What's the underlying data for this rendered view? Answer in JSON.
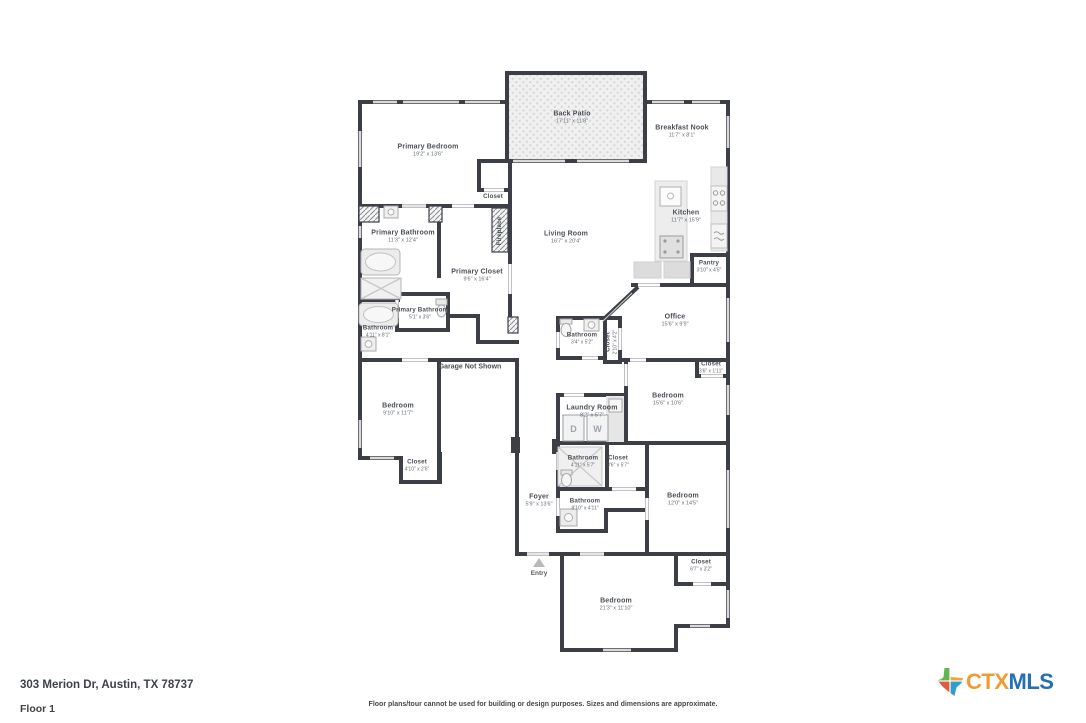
{
  "footer": {
    "address": "303 Merion Dr, Austin, TX 78737",
    "floor": "Floor 1",
    "disclaimer": "Floor plans/tour cannot be used for building or design purposes. Sizes and dimensions are approximate."
  },
  "logo": {
    "ctx": "CTX",
    "mls": "MLS",
    "colors": {
      "ctx_text": "#F09C33",
      "mls_text": "#2470B3",
      "texas_green": "#63B54F",
      "texas_orange": "#F2A33C",
      "texas_red": "#E05C3F",
      "texas_blue": "#2F9FD0"
    }
  },
  "colors": {
    "wall": "#3C4046",
    "window": "#D9D9D9",
    "room_name": "#4B5057",
    "room_dims": "#686D74"
  },
  "annotations": {
    "entry": "Entry",
    "garage": "Garage Not Shown"
  },
  "laundry": {
    "dryer": "D",
    "washer": "W"
  },
  "rooms": [
    {
      "name": "Back Patio",
      "dims": "17'11\" x 11'8\""
    },
    {
      "name": "Primary Bedroom",
      "dims": "19'2\" x 13'6\""
    },
    {
      "name": "Breakfast Nook",
      "dims": "11'7\" x 8'1\""
    },
    {
      "name": "Closet",
      "dims": ""
    },
    {
      "name": "Kitchen",
      "dims": "11'7\" x 15'9\""
    },
    {
      "name": "Living Room",
      "dims": "16'7\" x 20'4\""
    },
    {
      "name": "Fireplace",
      "dims": ""
    },
    {
      "name": "Primary Bathroom",
      "dims": "11'3\" x 12'4\""
    },
    {
      "name": "Primary Closet",
      "dims": "9'6\" x 16'4\""
    },
    {
      "name": "Pantry",
      "dims": "3'10\" x 4'5\""
    },
    {
      "name": "Office",
      "dims": "15'6\" x 9'9\""
    },
    {
      "name": "Primary Bathroom",
      "dims": "5'1\" x 3'6\""
    },
    {
      "name": "Bathroom",
      "dims": "4'11\" x 8'1\""
    },
    {
      "name": "Bathroom",
      "dims": "3'4\" x 5'2\""
    },
    {
      "name": "Closet",
      "dims": "2'10\" x 4'2\""
    },
    {
      "name": "Closet",
      "dims": "3'6\" x 1'11\""
    },
    {
      "name": "Bedroom",
      "dims": "9'10\" x 11'7\""
    },
    {
      "name": "Bedroom",
      "dims": "15'6\" x 10'6\""
    },
    {
      "name": "Laundry Room",
      "dims": "8'2\" x 5'7\""
    },
    {
      "name": "Closet",
      "dims": "4'10\" x 2'6\""
    },
    {
      "name": "Bathroom",
      "dims": "4'11\" x 5'7\""
    },
    {
      "name": "Closet",
      "dims": "3'6\" x 5'7\""
    },
    {
      "name": "Foyer",
      "dims": "5'9\" x 13'6\""
    },
    {
      "name": "Bathroom",
      "dims": "8'10\" x 4'11\""
    },
    {
      "name": "Bedroom",
      "dims": "12'0\" x 14'5\""
    },
    {
      "name": "Closet",
      "dims": "6'7\" x 3'2\""
    },
    {
      "name": "Bedroom",
      "dims": "21'3\" x 11'10\""
    }
  ]
}
